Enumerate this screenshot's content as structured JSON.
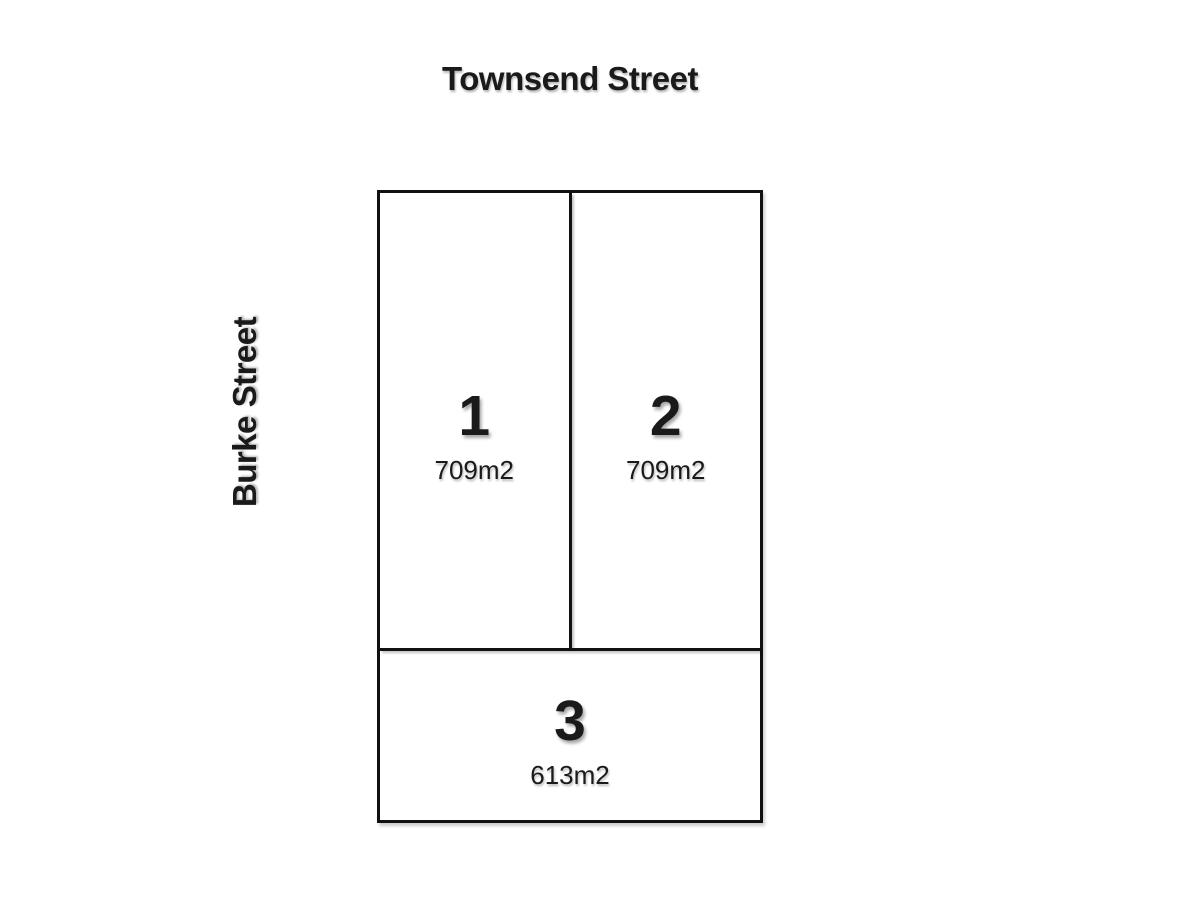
{
  "diagram": {
    "type": "lot-subdivision-plan",
    "top_street": "Townsend Street",
    "side_street": "Burke Street",
    "lots": [
      {
        "number": "1",
        "area": "709m2"
      },
      {
        "number": "2",
        "area": "709m2"
      },
      {
        "number": "3",
        "area": "613m2"
      }
    ]
  },
  "colors": {
    "background": "#ffffff",
    "boundary_line": "#111111",
    "text": "#1a1a1a"
  }
}
